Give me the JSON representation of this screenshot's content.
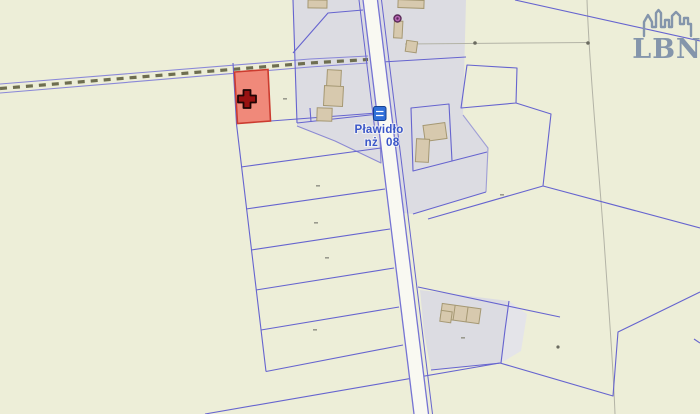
{
  "map": {
    "place_label": {
      "name": "Pławidło",
      "code_left": "nż",
      "code_right": "08"
    },
    "watermark": {
      "text": "LBN"
    },
    "icons": {
      "cross": "selected-parcel cross marker",
      "bus_stop": "bus-stop sign",
      "poi_dot": "point-of-interest dot",
      "skyline": "city skyline logo"
    },
    "colors": {
      "background": "#edeed8",
      "built_area": "#dcdce2",
      "built_area_light": "#e4e4e9",
      "parcel_line": "#6664cf",
      "road_fill": "#f9f9f2",
      "road_edge": "#7573d4",
      "building_fill": "#d7c9ae",
      "building_outline": "#a59873",
      "selected_fill": "#f0897a",
      "selected_stroke": "#cc3b2f",
      "cross_fill": "#991111",
      "cross_outline": "#1f0505",
      "label_text": "#3a56c8",
      "watermark_color": "#8495ab",
      "dash_line": "#6e6e50",
      "dash_band_edge": "#8a88d8",
      "faint_line": "#b3b3a6",
      "poi_dot": "#b565b2",
      "poi_dot_ring": "#5a2a58",
      "bus_sign": "#2f6fd8",
      "bus_sign_border": "#17418f",
      "survey_dot": "#6b6b60",
      "tick_mark": "#9a9a8e"
    }
  }
}
